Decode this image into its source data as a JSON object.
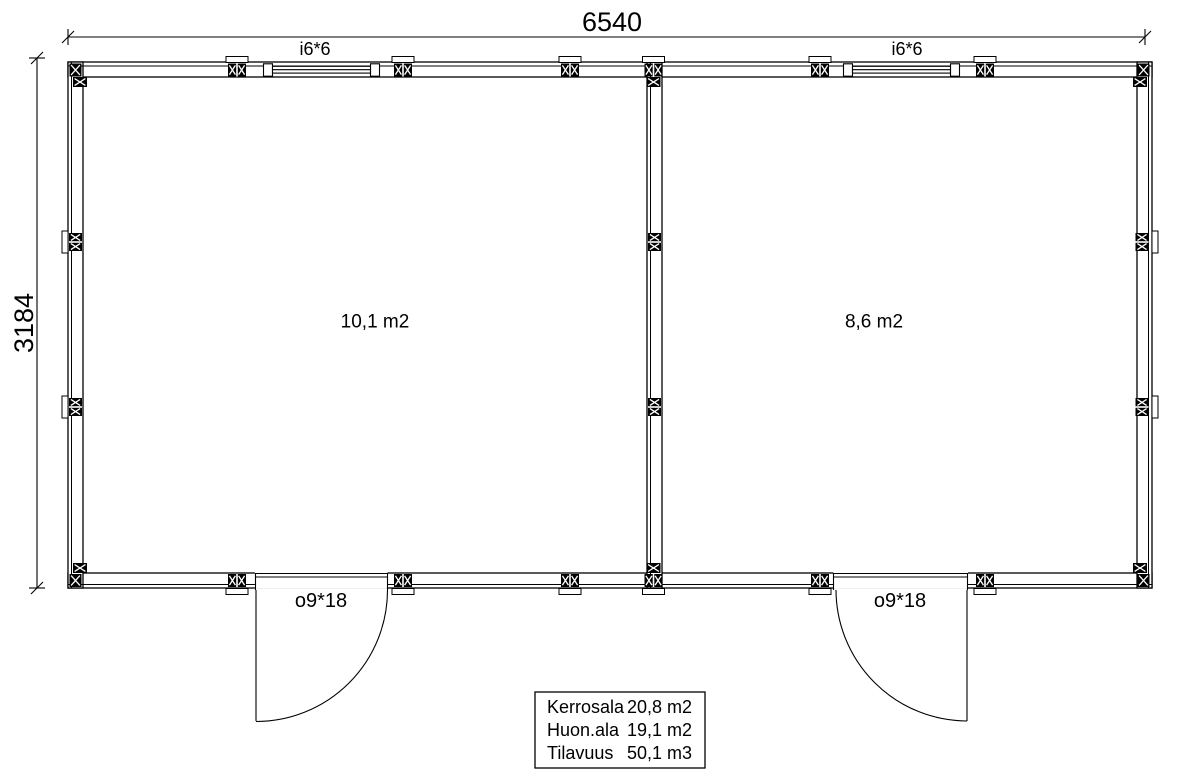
{
  "dimensions": {
    "width": "6540",
    "height": "3184"
  },
  "rooms": [
    {
      "area": "10,1 m2"
    },
    {
      "area": "8,6 m2"
    }
  ],
  "windows": [
    {
      "code": "i6*6"
    },
    {
      "code": "i6*6"
    }
  ],
  "doors": [
    {
      "code": "o9*18"
    },
    {
      "code": "o9*18"
    }
  ],
  "summary": {
    "rows": [
      {
        "label": "Kerrosala",
        "value": "20,8 m2"
      },
      {
        "label": "Huon.ala",
        "value": "19,1 m2"
      },
      {
        "label": "Tilavuus",
        "value": "50,1 m3"
      }
    ]
  },
  "colors": {
    "line": "#000000",
    "background": "#ffffff"
  },
  "plan": {
    "posts_pair_h": [
      [
        237,
        70
      ],
      [
        403,
        70
      ],
      [
        570,
        70
      ],
      [
        653.5,
        70
      ],
      [
        820,
        70
      ],
      [
        985,
        70
      ],
      [
        237,
        580.5
      ],
      [
        403,
        580.5
      ],
      [
        570,
        580.5
      ],
      [
        653.5,
        580.5
      ],
      [
        820,
        580.5
      ],
      [
        985,
        580.5
      ]
    ],
    "posts_pair_v": [
      [
        75.5,
        242
      ],
      [
        75.5,
        407
      ],
      [
        654.5,
        242
      ],
      [
        654.5,
        407
      ],
      [
        1142,
        242
      ],
      [
        1142,
        407
      ]
    ],
    "posts_single_h": [
      [
        80,
        82
      ],
      [
        653.5,
        82
      ],
      [
        1140,
        82
      ],
      [
        80,
        568
      ],
      [
        653.5,
        568
      ],
      [
        1140,
        568
      ]
    ],
    "posts_single_v": [
      [
        75.5,
        70
      ],
      [
        1143.5,
        70
      ],
      [
        75.5,
        580.5
      ],
      [
        1143.5,
        580.5
      ]
    ],
    "tabs_h": [
      [
        237,
        56.5
      ],
      [
        403,
        56.5
      ],
      [
        570,
        56.5
      ],
      [
        653.5,
        56.5
      ],
      [
        820,
        56.5
      ],
      [
        985,
        56.5
      ],
      [
        237,
        588.5
      ],
      [
        403,
        588.5
      ],
      [
        570,
        588.5
      ],
      [
        653.5,
        588.5
      ],
      [
        820,
        588.5
      ],
      [
        985,
        588.5
      ]
    ],
    "tabs_v": [
      [
        62,
        242
      ],
      [
        62,
        407
      ],
      [
        1152,
        242
      ],
      [
        1152,
        407
      ]
    ]
  }
}
